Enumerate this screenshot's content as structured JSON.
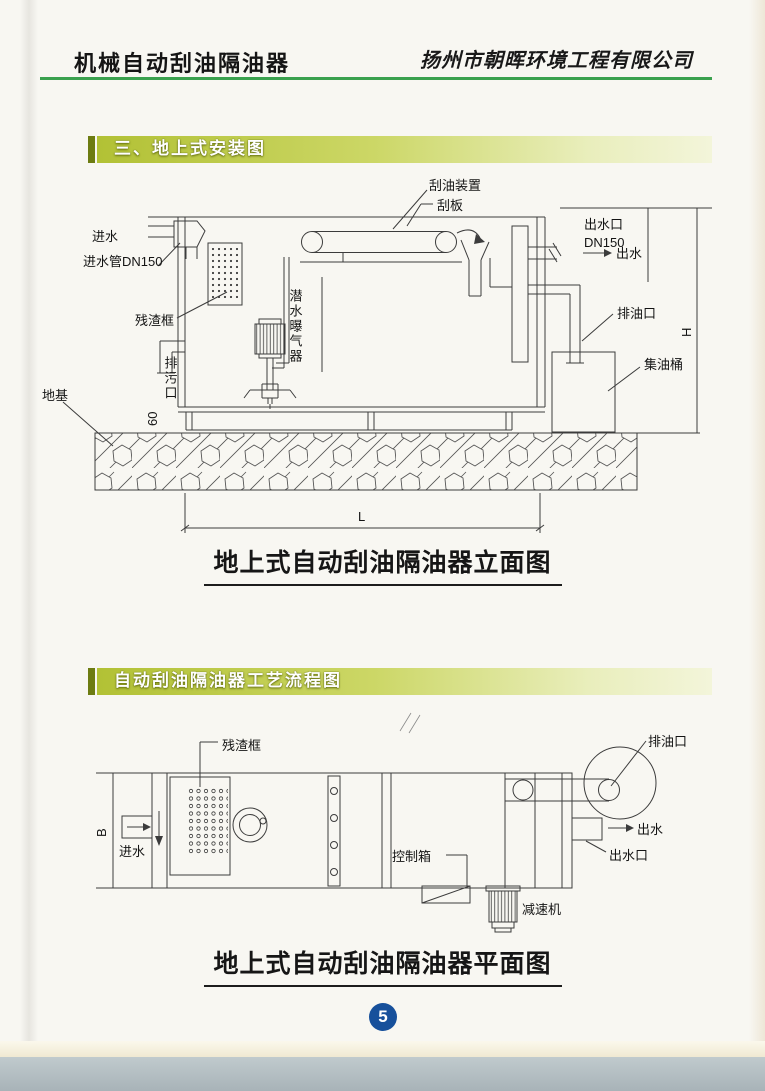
{
  "header": {
    "title": "机械自动刮油隔油器",
    "company": "扬州市朝晖环境工程有限公司"
  },
  "sections": [
    {
      "banner": "三、地上式安装图",
      "caption": "地上式自动刮油隔油器立面图"
    },
    {
      "banner": "自动刮油隔油器工艺流程图",
      "caption": "地上式自动刮油隔油器平面图"
    }
  ],
  "elevation": {
    "labels": {
      "water_inlet": "进水",
      "inlet_pipe": "进水管DN150",
      "residue_basket": "残渣框",
      "drain_outlet": "排污口",
      "foundation": "地基",
      "submersible_aerator": "潜水曝气器",
      "oil_scraping_device": "刮油装置",
      "scraper_plate": "刮板",
      "water_outlet_port": "出水口",
      "outlet_pipe_size": "DN150",
      "water_outlet": "出水",
      "oil_discharge_port": "排油口",
      "oil_collection_barrel": "集油桶"
    },
    "dimensions": {
      "height": "H",
      "length": "L",
      "base_offset": "60"
    }
  },
  "plan": {
    "labels": {
      "residue_basket": "残渣框",
      "water_inlet": "进水",
      "control_box": "控制箱",
      "speed_reducer": "减速机",
      "oil_discharge_port": "排油口",
      "water_outlet": "出水",
      "water_outlet_port": "出水口"
    },
    "dimensions": {
      "width": "B"
    }
  },
  "footer": {
    "page_number": "5"
  },
  "colors": {
    "header_rule_green": "#3aa14e",
    "banner_olive": "#b2c135",
    "banner_cap": "#6d7c12",
    "page_badge_blue": "#17509b",
    "line_color": "#3c3c3c"
  }
}
